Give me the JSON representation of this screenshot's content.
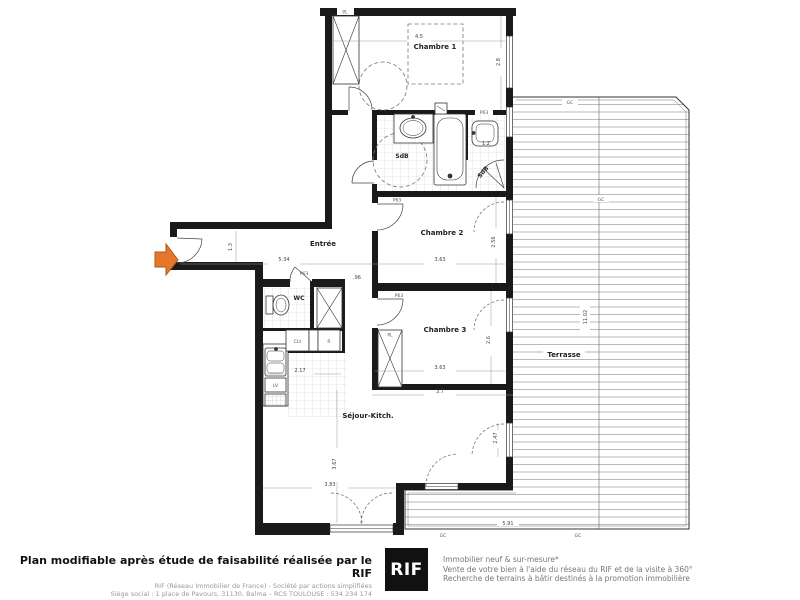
{
  "plan": {
    "rooms": {
      "chambre1": "Chambre 1",
      "chambre2": "Chambre 2",
      "chambre3": "Chambre 3",
      "sdb": "SdB",
      "sdb2": "SdB",
      "wc": "WC",
      "entree": "Entrée",
      "sejour": "Séjour-Kitch.",
      "terrasse": "Terrasse"
    },
    "fixtures": {
      "placard1": "PL",
      "placard2": "PL",
      "cellier": "CLt",
      "refrigerateur": "R",
      "lave_vaisselle": "LV"
    },
    "door_label": "P63",
    "deck_label": "GC",
    "dimensions": {
      "chambre1_width": "4.5",
      "chambre1_height": "2.8",
      "entree_width": "5.34",
      "entree_height": "1.3",
      "chambre2_width": "3.63",
      "chambre2_height": "2.56",
      "chambre3_width": "3.63",
      "chambre3_height": "2.6",
      "chambre3_width2": "3.7",
      "sejour_width": "3.83",
      "sejour_height": "3.67",
      "kitchen_width": "2.17",
      "passage_width": ".96",
      "sejour_door": "2.47",
      "sdb2_width": "1.2",
      "terrasse_height": "11.02",
      "terrasse_width": "5.91"
    }
  },
  "footer": {
    "headline": "Plan modifiable après étude de faisabilité réalisée par le RIF",
    "line1": "RIF (Réseau Immobilier de France)  -  Société par actions simplifiées",
    "line2": "Siège social : 1 place de Pavours, 31130, Balma – RCS TOULOUSE : 534 234 174",
    "logo": "RIF",
    "tagline1": "Immobilier neuf & sur-mesure*",
    "tagline2": "Vente de votre bien à l'aide du réseau du RIF et de la visite à 360°",
    "tagline3": "Recherche de terrains à bâtir destinés à la promotion immobilière"
  }
}
